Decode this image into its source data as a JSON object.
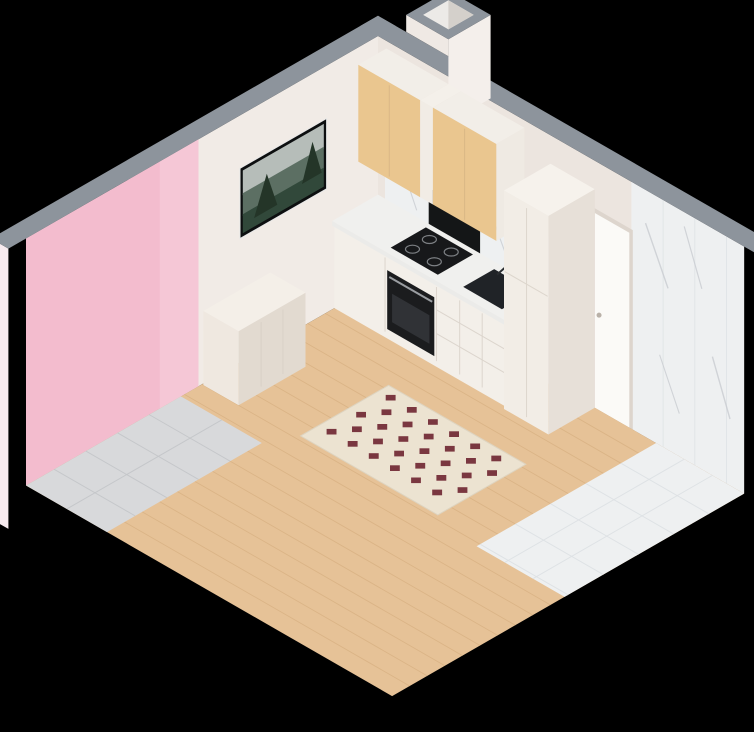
{
  "title": "isometric-cutaway-3d-floor-plan-studio-apartment",
  "colors": {
    "background": "#000000",
    "wall_top": "#8d949c",
    "wall_white": "#f1ebe6",
    "wall_white2": "#ece5df",
    "exterior_pink": "#f8ebef",
    "exterior_white": "#f5efe9",
    "accent_pink": "#f3bcce",
    "accent_pink_light": "#f5c7d6",
    "accent_red": "#f5322f",
    "accent_red_dark": "#d6201f",
    "floor_wood": "#e6c297",
    "floor_wood_line": "#d2a979",
    "floor_stone": "#d8d9db",
    "floor_marble": "#eef0f1",
    "marble_vein": "#c9ccd1",
    "kitchen_wood": "#eac68f",
    "kitchen_wood_dark": "#d6a86d",
    "cabinet_white": "#f3efe9",
    "appliance_black": "#17181a",
    "counter": "#ebebe9",
    "sofa_cream": "#f1ebe0",
    "rug_cream": "#ece3d1",
    "rug_red": "#6e2430",
    "bed_white": "#f4f1ea",
    "machine_silver": "#b7b1ac",
    "toilet_white": "#fbfbf9",
    "table_wood": "#e8c28c",
    "chair_cream": "#f1ece2",
    "leg_dark": "#3a3a3c",
    "door_gray": "#a7abb0",
    "plant_green": "#4a8736",
    "glass": "#dfe9ee"
  },
  "rooms": [
    {
      "name": "living-room-kitchen",
      "furniture": [
        "wall-tv",
        "sideboard",
        "dining-table",
        "dining-chairs",
        "place-settings",
        "pampas-vase",
        "kitchen-upper-cabinets",
        "kitchen-base-cabinets",
        "induction-cooktop",
        "built-in-oven",
        "kitchen-sink",
        "tall-cabinet",
        "curved-sofa",
        "curved-armchair",
        "diamond-pattern-rug"
      ]
    },
    {
      "name": "balcony",
      "furniture": [
        "palm-plant"
      ]
    },
    {
      "name": "bedroom",
      "furniture": [
        "double-bed",
        "pillows",
        "gray-interior-door"
      ]
    },
    {
      "name": "hallway",
      "furniture": [
        "slatted-wood-wardrobe"
      ]
    },
    {
      "name": "bathroom",
      "furniture": [
        "washing-machine",
        "laundry-basket",
        "bathtub",
        "toilet",
        "niche-walls"
      ]
    }
  ],
  "architecture": [
    "red-window-frames",
    "red-glass-balcony-door",
    "pink-accent-wall",
    "gray-wall-tops",
    "white-entry-door",
    "marble-tile-walls",
    "ventilation-shaft"
  ]
}
